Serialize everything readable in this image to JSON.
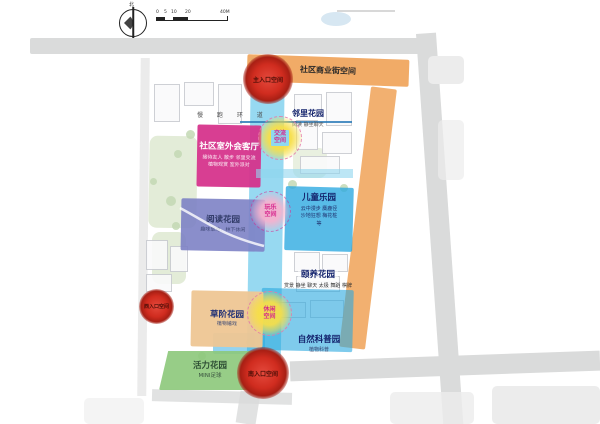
{
  "legend": {
    "north_label": "北",
    "scale_labels": [
      "0",
      "5",
      "10",
      "20",
      "40M"
    ]
  },
  "corridor": {
    "path_label": "慢 跑 环 道"
  },
  "zones": {
    "commercial_street": {
      "label": "社区商业街空间"
    },
    "outdoor_lounge": {
      "label": "社区室外会客厅",
      "sub1": "接待友人 散步 邻里交流",
      "sub2": "植物观赏 室外派对"
    },
    "neighbor_garden": {
      "label": "邻里花园",
      "sub": "阅读 静坐聊天"
    },
    "reading_garden": {
      "label": "阅读花园",
      "sub": "趣味草地，林下休闲"
    },
    "children_park": {
      "label": "儿童乐园",
      "sub1": "云中漫步 麋鹿径",
      "sub2": "沙地狂想 梅花桩",
      "sub3": "等"
    },
    "wellness_garden": {
      "label": "颐养花园",
      "sub": "赏景 静坐 聊天 太极 舞蹈 棋牌"
    },
    "grass_terrace_garden": {
      "label": "草阶花园",
      "sub": "植物嬉戏"
    },
    "nature_garden": {
      "label": "自然科普园",
      "sub": "植物科普"
    },
    "vitality_garden": {
      "label": "活力花园",
      "sub": "MINI足球"
    }
  },
  "nodes": {
    "main_entrance": {
      "label": "主入口空间"
    },
    "west_entrance": {
      "label": "西入口空间"
    },
    "south_entrance": {
      "label": "南入口空间"
    },
    "exchange_space": {
      "line1": "交流",
      "line2": "空间"
    },
    "play_space": {
      "line1": "玩乐",
      "line2": "空间"
    },
    "leisure_space": {
      "line1": "休闲",
      "line2": "空间"
    }
  },
  "colors": {
    "corridor": "#2fb4e4",
    "commercial": "#f0a257",
    "lounge": "#d6308a",
    "reading": "#7e82c6",
    "children": "#29a8e0",
    "grass_terrace": "#efc794",
    "vitality": "#8cc87a",
    "entrance_red": "#c8271b",
    "node_yellow": "#f6de49",
    "node_pink": "#f4b2ce",
    "label_navy": "#14246e",
    "label_magenta": "#d6258c"
  }
}
